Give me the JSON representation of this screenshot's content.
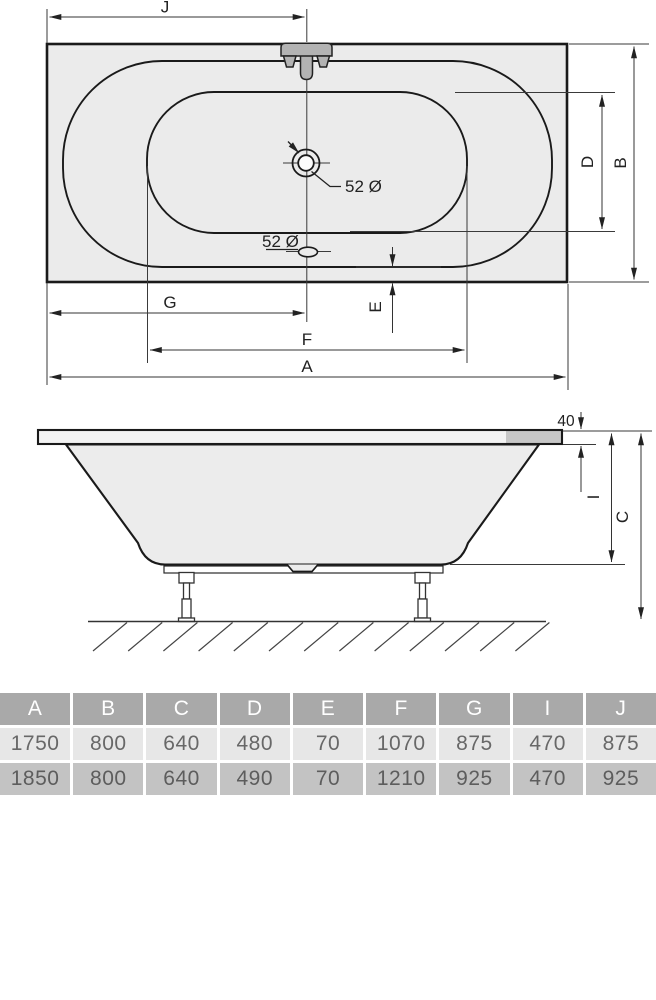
{
  "drawing": {
    "dims": {
      "J": "J",
      "G": "G",
      "F": "F",
      "A": "A",
      "B": "B",
      "D": "D",
      "E": "E",
      "I": "I",
      "C": "C"
    },
    "annotations": {
      "drain_diameter": "52 Ø",
      "overflow_diameter": "52 Ø",
      "rim_thickness": "40"
    }
  },
  "table": {
    "headers": [
      "A",
      "B",
      "C",
      "D",
      "E",
      "F",
      "G",
      "I",
      "J"
    ],
    "rows": [
      [
        "1750",
        "800",
        "640",
        "480",
        "70",
        "1070",
        "875",
        "470",
        "875"
      ],
      [
        "1850",
        "800",
        "640",
        "490",
        "70",
        "1210",
        "925",
        "470",
        "925"
      ]
    ]
  },
  "colors": {
    "tub_fill": "#ebebeb",
    "line": "#1a1a1a",
    "faucet_fill": "#b3b3b3",
    "table_header_bg": "#a9a9a9",
    "table_row1_bg": "#e7e7e7",
    "table_row2_bg": "#c3c3c3"
  }
}
